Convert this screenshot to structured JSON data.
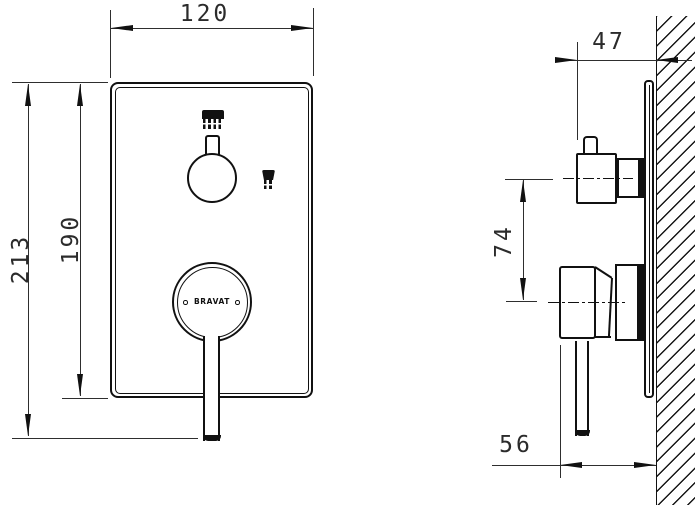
{
  "drawing": {
    "type": "technical-installation-drawing",
    "brand_logo": "BRAVAT",
    "dims": {
      "front_width": "120",
      "front_overall_height": "213",
      "front_plate_height": "190",
      "side_depth": "47",
      "side_center_distance": "74",
      "side_projection": "56"
    },
    "icons": {
      "top": "overhead-shower-icon",
      "right": "hand-shower-icon"
    },
    "colors": {
      "line": "#111111",
      "dimension": "#2b2b2b",
      "background": "#ffffff"
    }
  }
}
